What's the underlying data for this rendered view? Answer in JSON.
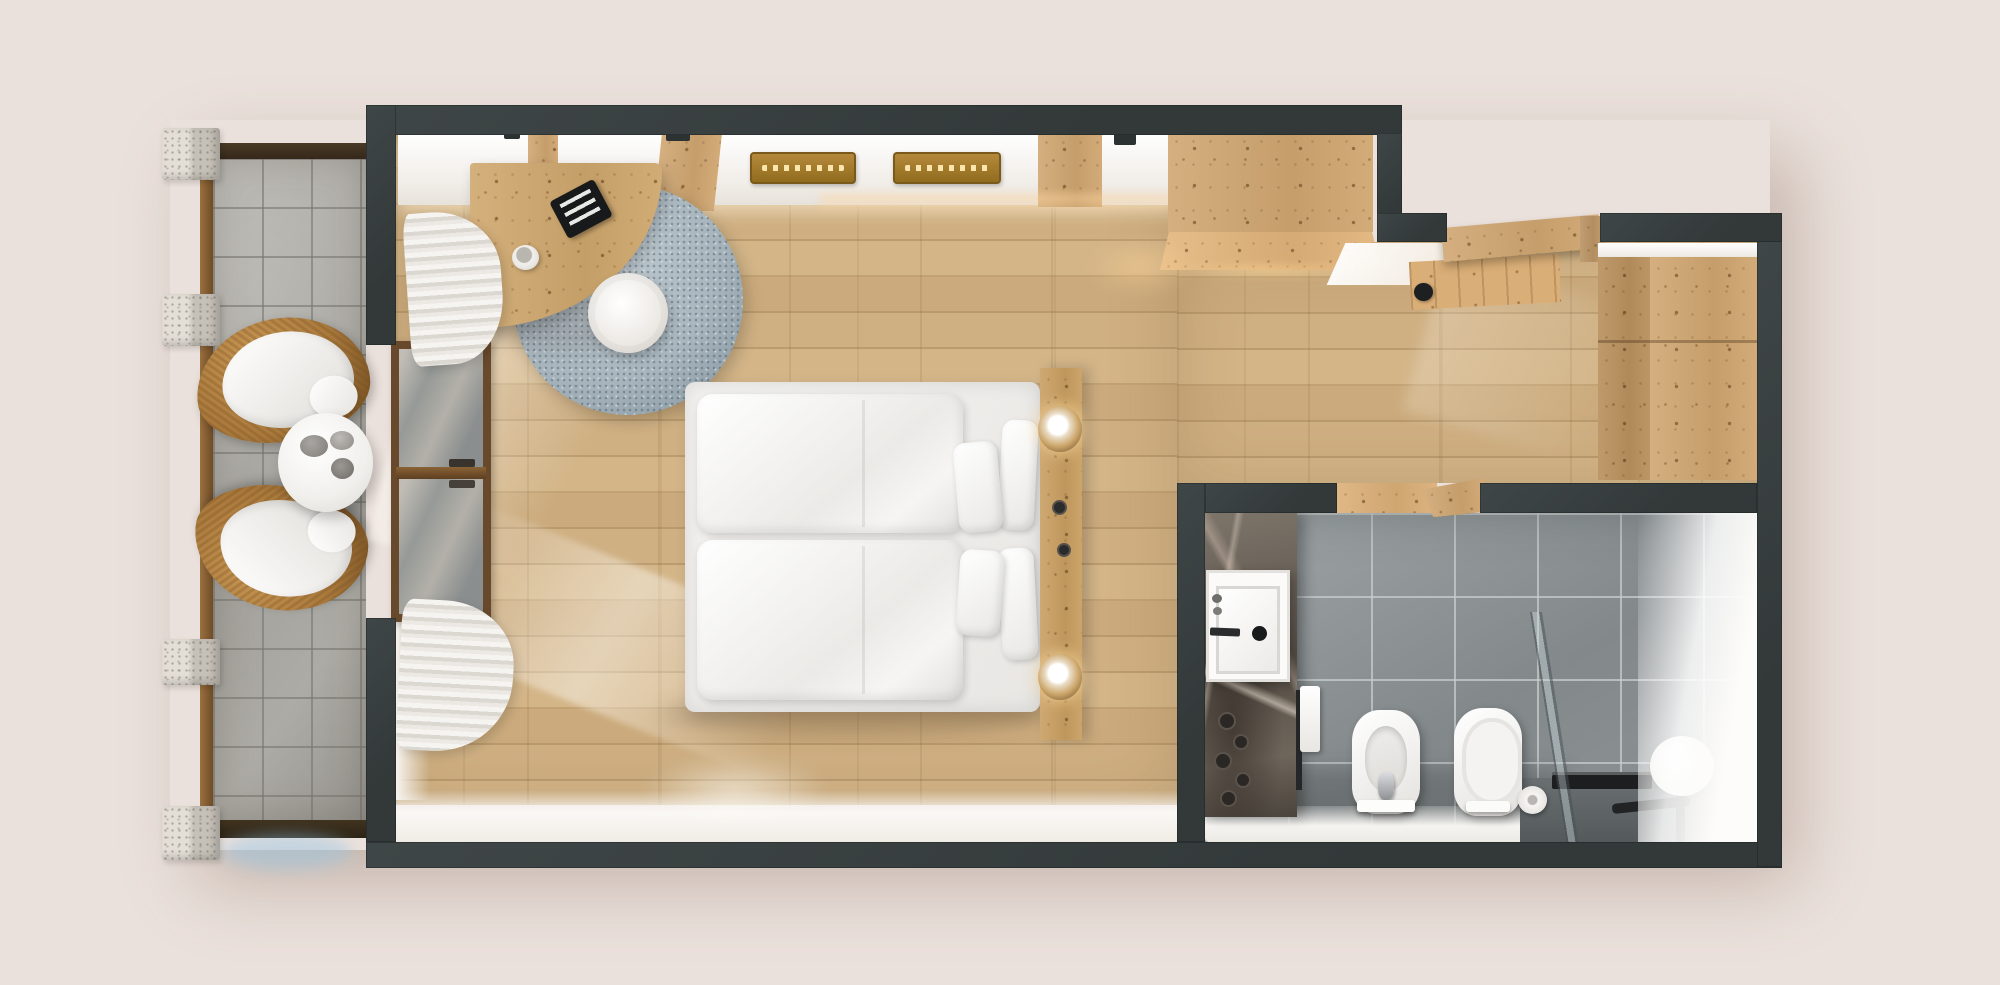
{
  "meta": {
    "title": "Top-down 3D floor plan render — hotel double room",
    "render_style": "photorealistic architectural top view",
    "visible_text": "none"
  },
  "palette": {
    "background": "#ebe1dc",
    "wall_dark": "#3a4142",
    "wood_floor": "#c8a87a",
    "pine_furniture": "#d0a671",
    "balcony_tile": "#aaa8a2",
    "stone_pillar": "#d7d2c9",
    "bath_tile": "#8e9395",
    "marble_dark": "#6b635a",
    "linen_white": "#f4f3f1",
    "rug_blue_gray": "#a4b1ba",
    "wicker_tan": "#a9793c",
    "lamp_glow": "#ffdca0",
    "fixture_black": "#1d1f20"
  },
  "rooms": {
    "balcony": {
      "label": "Balcony terrace with seating"
    },
    "bedroom": {
      "label": "Bedroom and living area"
    },
    "entry": {
      "label": "Entry hall"
    },
    "bathroom": {
      "label": "Bathroom"
    }
  },
  "furniture": {
    "chair1": {
      "label": "Wicker lounge chair with white cushion"
    },
    "chair2": {
      "label": "Wicker lounge chair with white cushion"
    },
    "table": {
      "label": "Round white bistro table with cups"
    },
    "desk": {
      "label": "Curved wooden corner desk"
    },
    "laptop": {
      "label": "Laptop on desk"
    },
    "cup": {
      "label": "Coffee cup on desk"
    },
    "rug": {
      "label": "Round gray shag rug"
    },
    "pouf": {
      "label": "Round white pouf"
    },
    "curtain_top": {
      "label": "Pleated sheer curtain (upper)"
    },
    "curtain_bottom": {
      "label": "Pleated sheer curtain (lower)"
    },
    "window": {
      "label": "Sliding glass balcony door"
    },
    "ledge": {
      "label": "Wall bench with carved wooden trays"
    },
    "bed": {
      "label": "Double bed with two duvets and four pillows"
    },
    "headboard": {
      "label": "Rustic wood headboard with two reading lamps"
    },
    "cabinet": {
      "label": "Built-in pine cabinet / luggage bench"
    },
    "wardrobe": {
      "label": "Built-in pine wardrobe"
    },
    "entry_door": {
      "label": "Entrance door, open"
    },
    "bath_door": {
      "label": "Bathroom door, open"
    },
    "sink": {
      "label": "Vanity washbasin on marble wall"
    },
    "towel": {
      "label": "Towel on radiator rail"
    },
    "bidet": {
      "label": "Bidet"
    },
    "toilet": {
      "label": "Wall-hung toilet"
    },
    "paper_roll": {
      "label": "Toilet paper roll"
    },
    "shower": {
      "label": "Walk-in shower with glass screen and linear drain"
    },
    "mirror": {
      "label": "Round mirror leaning in shower area"
    }
  }
}
